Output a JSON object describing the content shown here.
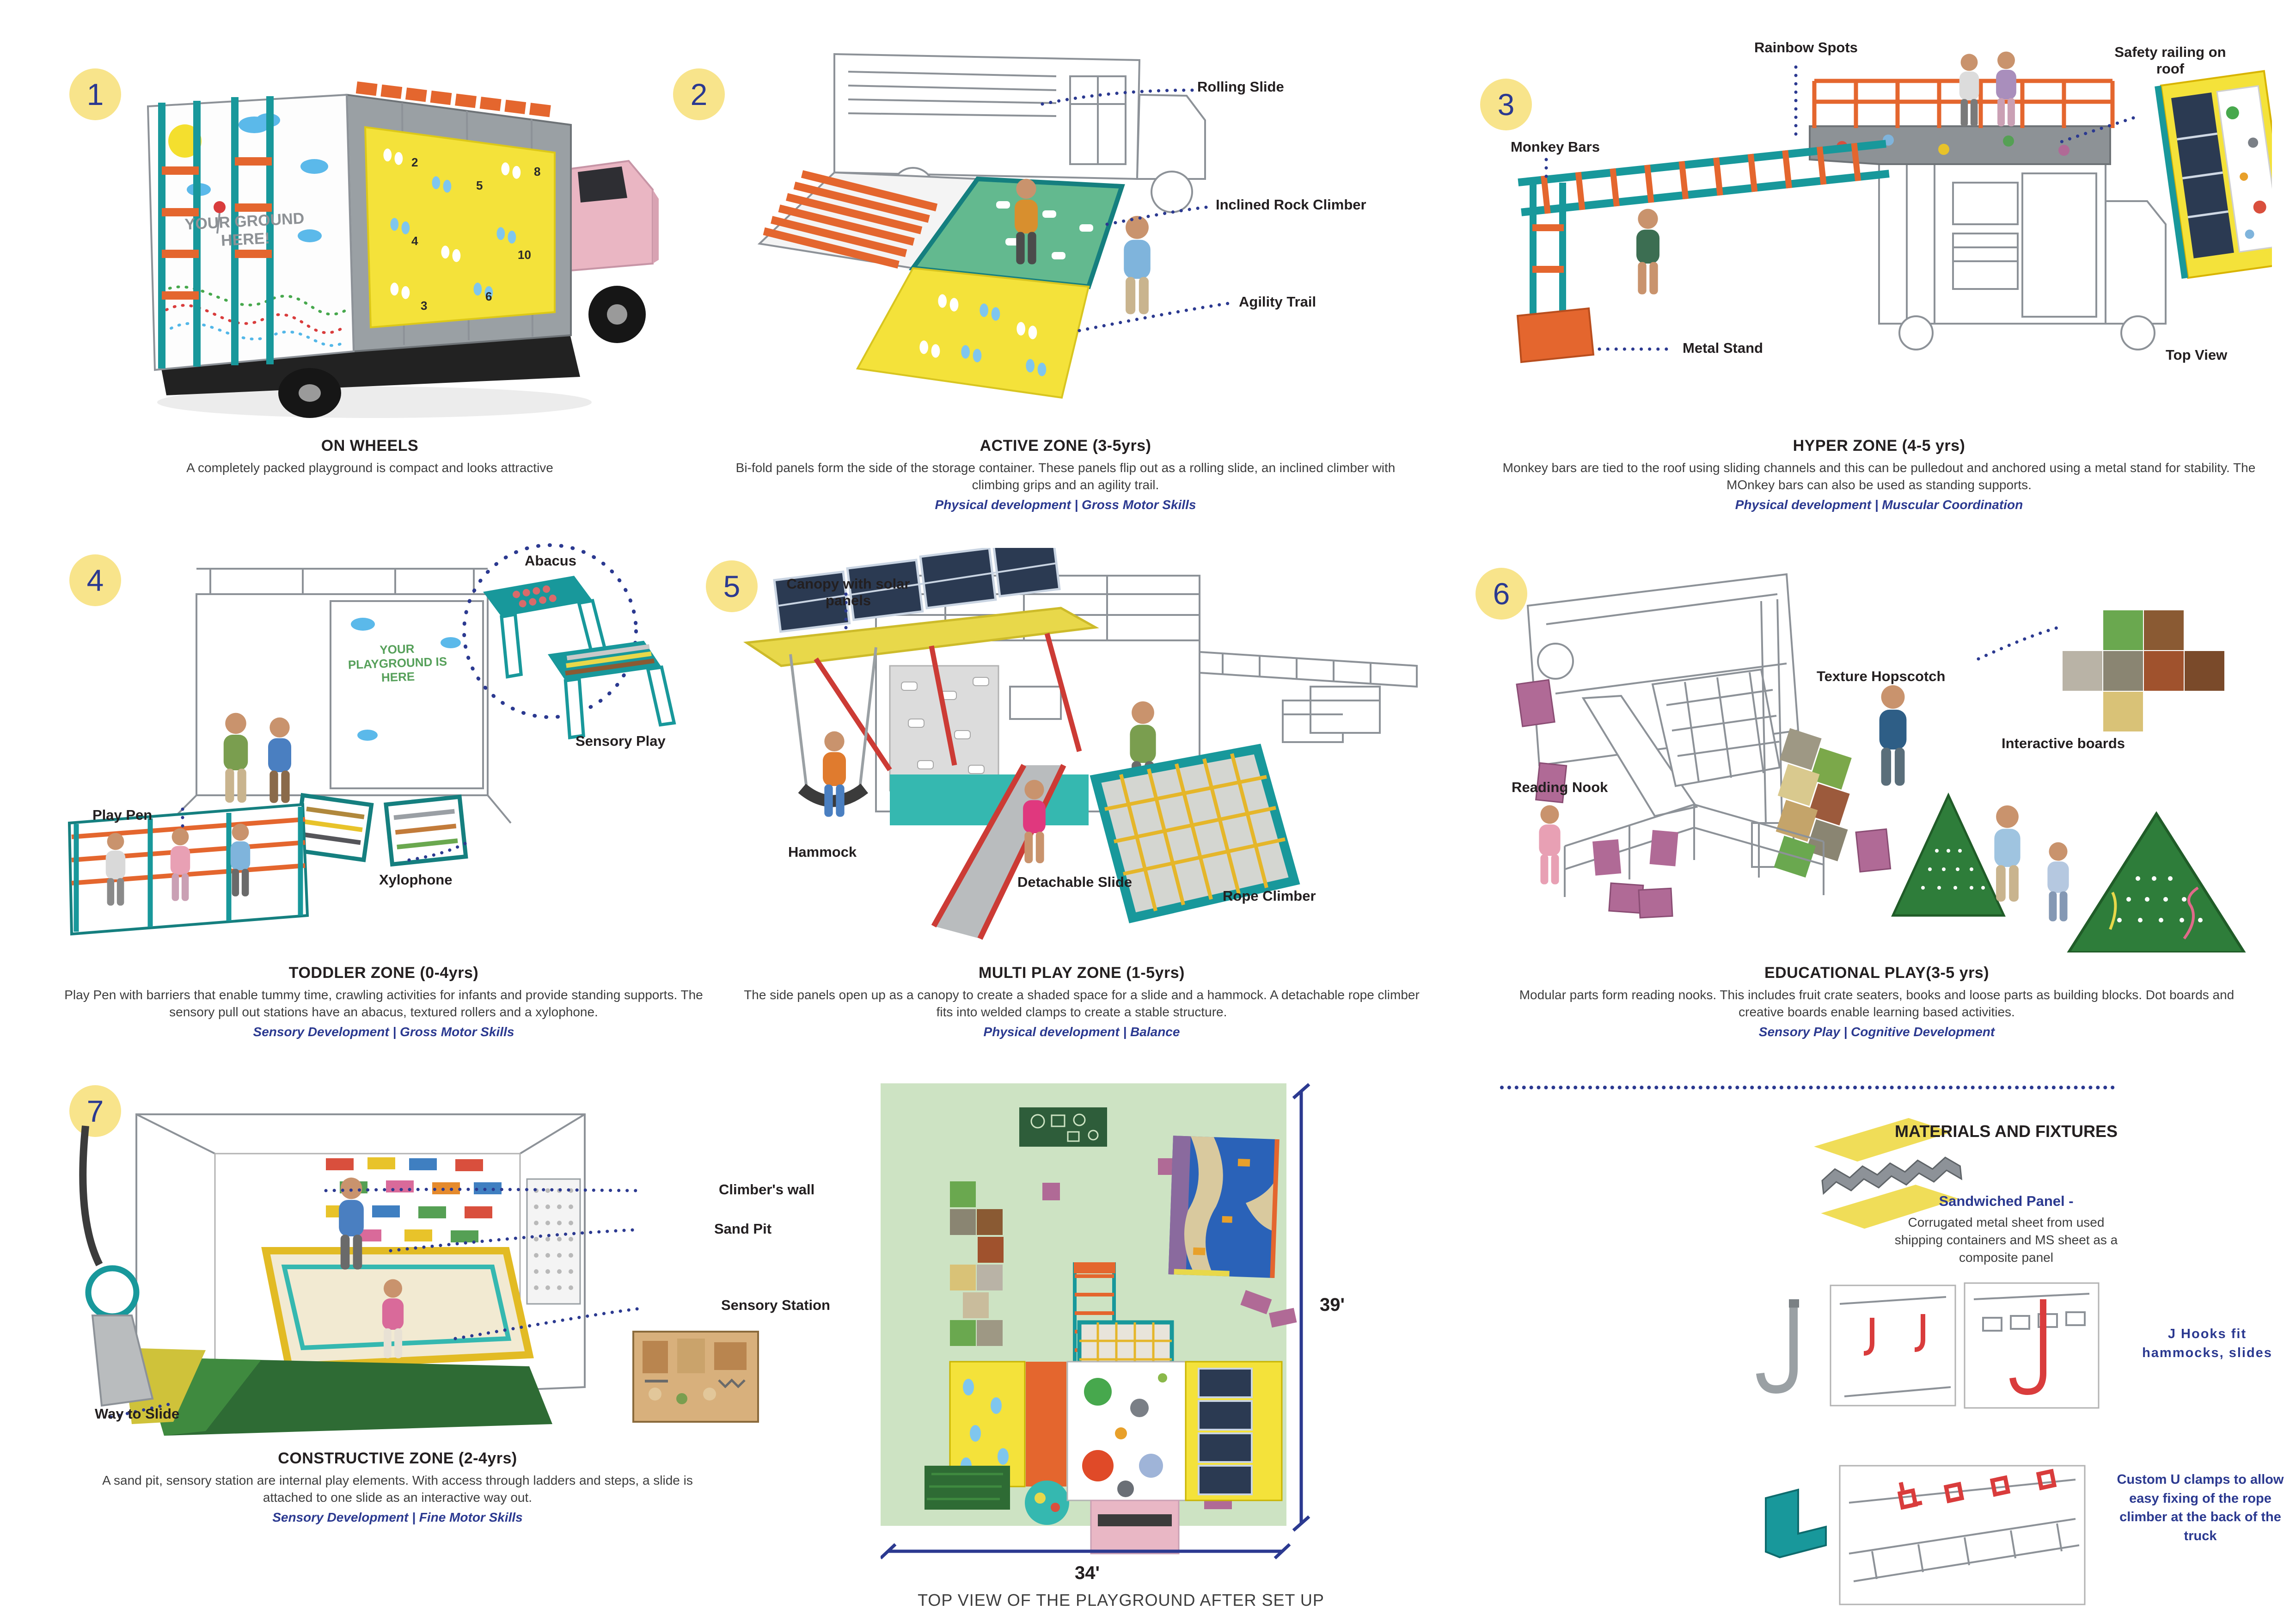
{
  "board": {
    "panels": [
      {
        "num": "1",
        "title": "ON WHEELS",
        "desc": "A completely packed playground is compact and looks attractive",
        "skills": "",
        "sign": "YOUR GROUND HERE!",
        "labels": []
      },
      {
        "num": "2",
        "title": "ACTIVE ZONE (3-5yrs)",
        "desc": "Bi-fold panels form the side of the storage container. These panels flip out as a rolling slide, an inclined climber with climbing grips and an agility trail.",
        "skills": "Physical development | Gross Motor Skills",
        "labels": [
          "Rolling Slide",
          "Inclined Rock Climber",
          "Agility Trail"
        ]
      },
      {
        "num": "3",
        "title": "HYPER ZONE (4-5 yrs)",
        "desc": "Monkey bars are tied to the roof using sliding channels and this can be pulledout and anchored using a metal stand for stability. The MOnkey bars can also be used as standing supports.",
        "skills": "Physical development | Muscular Coordination",
        "labels": [
          "Rainbow Spots",
          "Safety railing on roof",
          "Monkey Bars",
          "Metal Stand",
          "Top View"
        ]
      },
      {
        "num": "4",
        "title": "TODDLER ZONE (0-4yrs)",
        "desc": "Play Pen with barriers that enable tummy time, crawling activities for infants and provide standing supports. The sensory pull out stations have an abacus, textured rollers and a xylophone.",
        "skills": "Sensory Development | Gross Motor Skills",
        "sign": "YOUR PLAYGROUND IS HERE",
        "labels": [
          "Abacus",
          "Sensory Play",
          "Play Pen",
          "Xylophone"
        ]
      },
      {
        "num": "5",
        "title": "MULTI PLAY ZONE (1-5yrs)",
        "desc": "The side panels open up as a canopy to create a shaded space for a slide and a hammock. A detachable rope climber fits into welded clamps to create a stable structure.",
        "skills": "Physical development | Balance",
        "labels": [
          "Canopy with solar panels",
          "Hammock",
          "Detachable Slide",
          "Rope Climber"
        ]
      },
      {
        "num": "6",
        "title": "EDUCATIONAL PLAY(3-5 yrs)",
        "desc": "Modular parts form reading nooks. This includes fruit crate seaters, books and loose parts as building blocks. Dot boards and creative boards enable learning based activities.",
        "skills": "Sensory Play | Cognitive Development",
        "labels": [
          "Texture Hopscotch",
          "Interactive boards",
          "Reading Nook"
        ]
      },
      {
        "num": "7",
        "title": "CONSTRUCTIVE ZONE (2-4yrs)",
        "desc": "A sand pit, sensory station are internal play elements. With access through ladders and steps, a slide is attached to one slide as an interactive way out.",
        "skills": "Sensory Development | Fine Motor Skills",
        "labels": [
          "Climber's wall",
          "Sand Pit",
          "Sensory Station",
          "Way to Slide"
        ]
      }
    ],
    "top_view": {
      "caption": "TOP VIEW OF THE PLAYGROUND AFTER SET UP",
      "height_dim": "39'",
      "width_dim": "34'"
    },
    "materials": {
      "heading": "MATERIALS AND FIXTURES",
      "panel_title": "Sandwiched Panel -",
      "panel_desc": "Corrugated metal sheet from used shipping containers and MS sheet as a composite panel",
      "jhooks": "J Hooks fit hammocks, slides",
      "uclamps": "Custom U clamps to allow easy fixing of the rope climber at the back of the truck"
    },
    "colors": {
      "accent_navy": "#2b3990",
      "badge_yellow": "#f8e48b",
      "teal": "#18989b",
      "orange": "#e4662e",
      "yellow": "#f4e23a",
      "pink": "#e9b7c5",
      "grass": "#cde3c3",
      "skill_blue": "#2b3990"
    }
  }
}
